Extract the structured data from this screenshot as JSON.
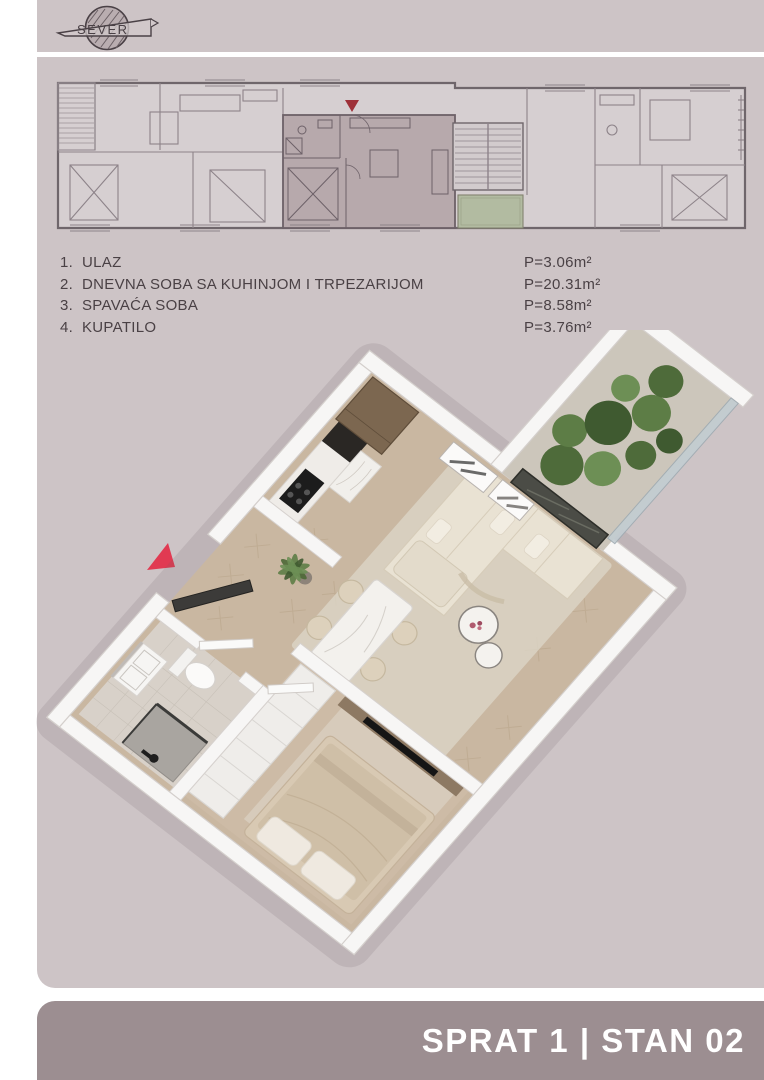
{
  "page": {
    "background": "#cdc4c6",
    "footer_background": "#9c8e91",
    "text_color": "#4a4145",
    "white": "#ffffff"
  },
  "logo": {
    "text": "SEVER"
  },
  "plan2d": {
    "entrance_marker_color": "#9e3038",
    "unit_highlight_color": "#b7a9ac",
    "terrace_color": "#b2bba1"
  },
  "legend": {
    "items": [
      {
        "no": "1.",
        "name": "ULAZ",
        "area": "P=3.06m²"
      },
      {
        "no": "2.",
        "name": "DNEVNA SOBA SA KUHINJOM I TRPEZARIJOM",
        "area": "P=20.31m²"
      },
      {
        "no": "3.",
        "name": "SPAVAĆA SOBA",
        "area": "P=8.58m²"
      },
      {
        "no": "4.",
        "name": "KUPATILO",
        "area": "P=3.76m²"
      }
    ]
  },
  "render3d": {
    "entrance_arrow_color": "#e13a52"
  },
  "footer": {
    "title": "SPRAT 1 | STAN 02"
  }
}
